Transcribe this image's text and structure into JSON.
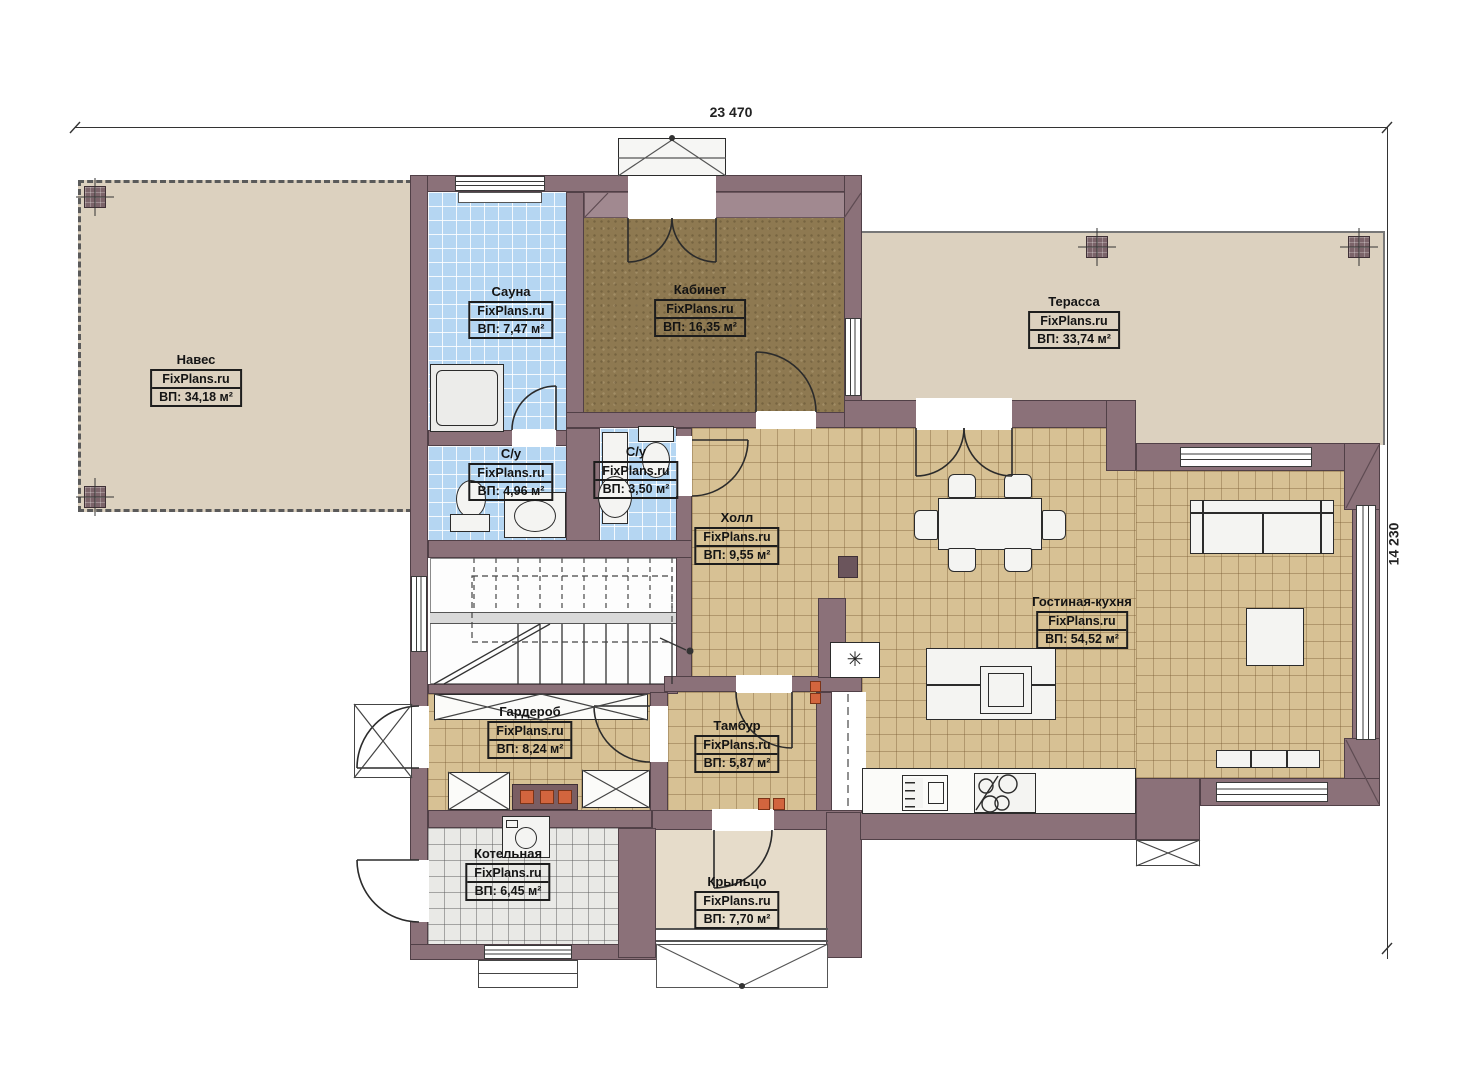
{
  "dimensions": {
    "width_label": "23 470",
    "height_label": "14 230"
  },
  "symbols": {
    "flue_star": "✳"
  },
  "rooms": [
    {
      "key": "naves",
      "name": "Навес",
      "watermark": "FixPlans.ru",
      "area": "ВП: 34,18 м²"
    },
    {
      "key": "sauna",
      "name": "Сауна",
      "watermark": "FixPlans.ru",
      "area": "ВП: 7,47 м²"
    },
    {
      "key": "kabinet",
      "name": "Кабинет",
      "watermark": "FixPlans.ru",
      "area": "ВП: 16,35 м²"
    },
    {
      "key": "terassa",
      "name": "Терасса",
      "watermark": "FixPlans.ru",
      "area": "ВП: 33,74 м²"
    },
    {
      "key": "su_1",
      "name": "С/у",
      "watermark": "FixPlans.ru",
      "area": "ВП: 4,96 м²"
    },
    {
      "key": "su_2",
      "name": "С/у",
      "watermark": "FixPlans.ru",
      "area": "ВП: 3,50 м²"
    },
    {
      "key": "holl",
      "name": "Холл",
      "watermark": "FixPlans.ru",
      "area": "ВП: 9,55 м²"
    },
    {
      "key": "gostinaya_kuhnya",
      "name": "Гостиная-кухня",
      "watermark": "FixPlans.ru",
      "area": "ВП: 54,52 м²"
    },
    {
      "key": "garderob",
      "name": "Гардероб",
      "watermark": "FixPlans.ru",
      "area": "ВП: 8,24 м²"
    },
    {
      "key": "tambur",
      "name": "Тамбур",
      "watermark": "FixPlans.ru",
      "area": "ВП: 5,87 м²"
    },
    {
      "key": "kotelnaya",
      "name": "Котельная",
      "watermark": "FixPlans.ru",
      "area": "ВП: 6,45 м²"
    },
    {
      "key": "krylco",
      "name": "Крыльцо",
      "watermark": "FixPlans.ru",
      "area": "ВП: 7,70 м²"
    }
  ],
  "colors": {
    "wall": "#8b7179",
    "wall_light": "#a18990",
    "floor_beige": "#dcd1bf",
    "floor_porch": "#e6dcca",
    "tile_blue": "#b5d6f2",
    "tile_tan": "#d7c194",
    "tile_grey": "#e9e9e6",
    "carpet_office": "#8e7951",
    "accent_orange": "#d2653e",
    "line": "#2b2b2b"
  }
}
